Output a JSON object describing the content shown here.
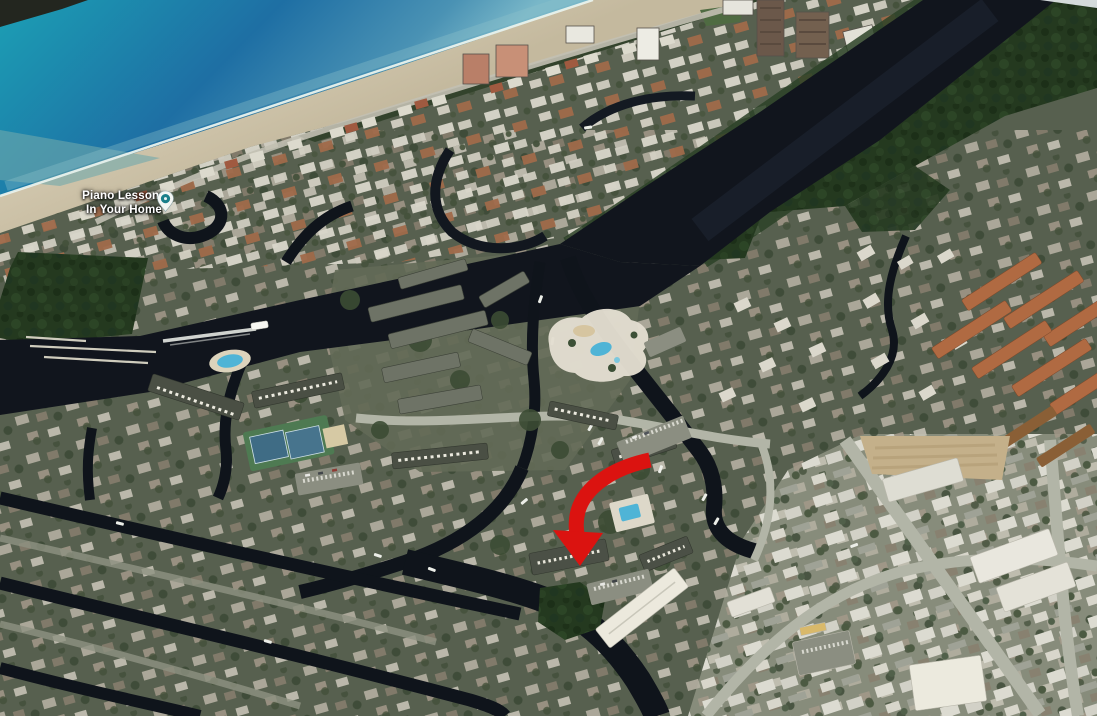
{
  "map": {
    "view": "3D aerial satellite view of coastal neighborhood with beach, intracoastal waterway and canals",
    "place_label": {
      "line1": "Piano Lessons",
      "line2": "In Your Home"
    },
    "icons": {
      "pin": "place-pin",
      "arrow": "location-arrow"
    }
  },
  "colors": {
    "ocean-far": "#1BA4B6",
    "ocean-mid": "#1E6FA4",
    "ocean-near": "#79B7C8",
    "sand": "#DCD2BA",
    "sand-dark": "#C4B99E",
    "surf": "#EAF2EC",
    "res-base": "#57604F",
    "res-light": "#878C7B",
    "veg": "#33432C",
    "mangrove": "#24391F",
    "water-dark": "#11151D",
    "canal": "#0F141B",
    "road": "#B2B5A7",
    "roof-white": "#ECEAE0",
    "roof-terra": "#B06A42",
    "pool": "#4FB4D6",
    "tennis": "#3F6C85",
    "arrow": "#DB1310",
    "pin-teal": "#1A7F8A",
    "label-text": "#FFFFFF"
  }
}
